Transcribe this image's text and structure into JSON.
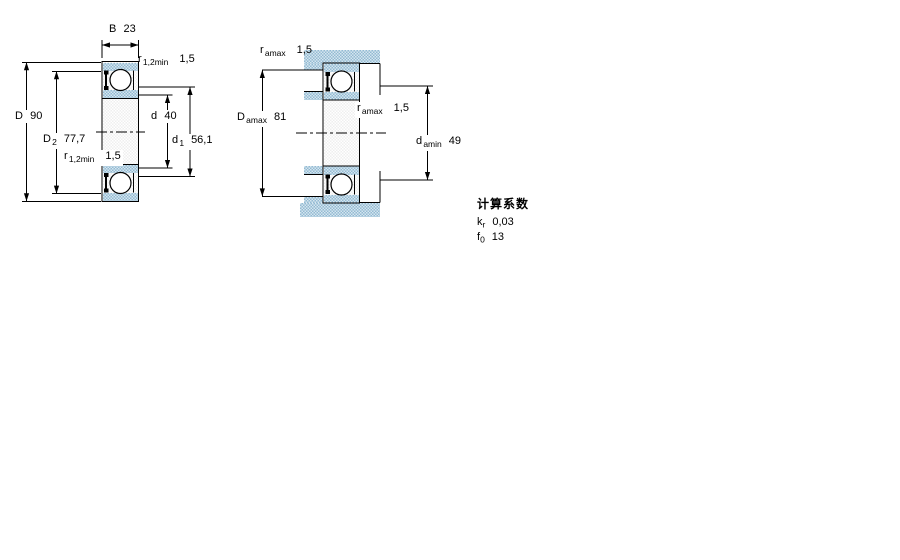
{
  "colors": {
    "tint_blue": "#93bad3",
    "tint_light": "#d6e6ef",
    "line": "#000000",
    "background": "#ffffff"
  },
  "left_view": {
    "B": {
      "sym": "B",
      "val": "23"
    },
    "r_top": {
      "sym": "r",
      "sub": "1,2min",
      "val": "1,5"
    },
    "D": {
      "sym": "D",
      "val": "90"
    },
    "D2": {
      "sym": "D",
      "sub": "2",
      "val": "77,7"
    },
    "r_bottom": {
      "sym": "r",
      "sub": "1,2min",
      "val": "1,5"
    },
    "d": {
      "sym": "d",
      "val": "40"
    },
    "d1": {
      "sym": "d",
      "sub": "1",
      "val": "56,1"
    }
  },
  "right_view": {
    "r_top": {
      "sym": "r",
      "sub": "amax",
      "val": "1,5"
    },
    "Damax": {
      "sym": "D",
      "sub": "amax",
      "val": "81"
    },
    "r_mid": {
      "sym": "r",
      "sub": "amax",
      "val": "1,5"
    },
    "damin": {
      "sym": "d",
      "sub": "amin",
      "val": "49"
    }
  },
  "factors": {
    "title": "计算系数",
    "rows": [
      {
        "sym": "k",
        "sub": "r",
        "val": "0,03"
      },
      {
        "sym": "f",
        "sub": "0",
        "val": "13"
      }
    ]
  }
}
